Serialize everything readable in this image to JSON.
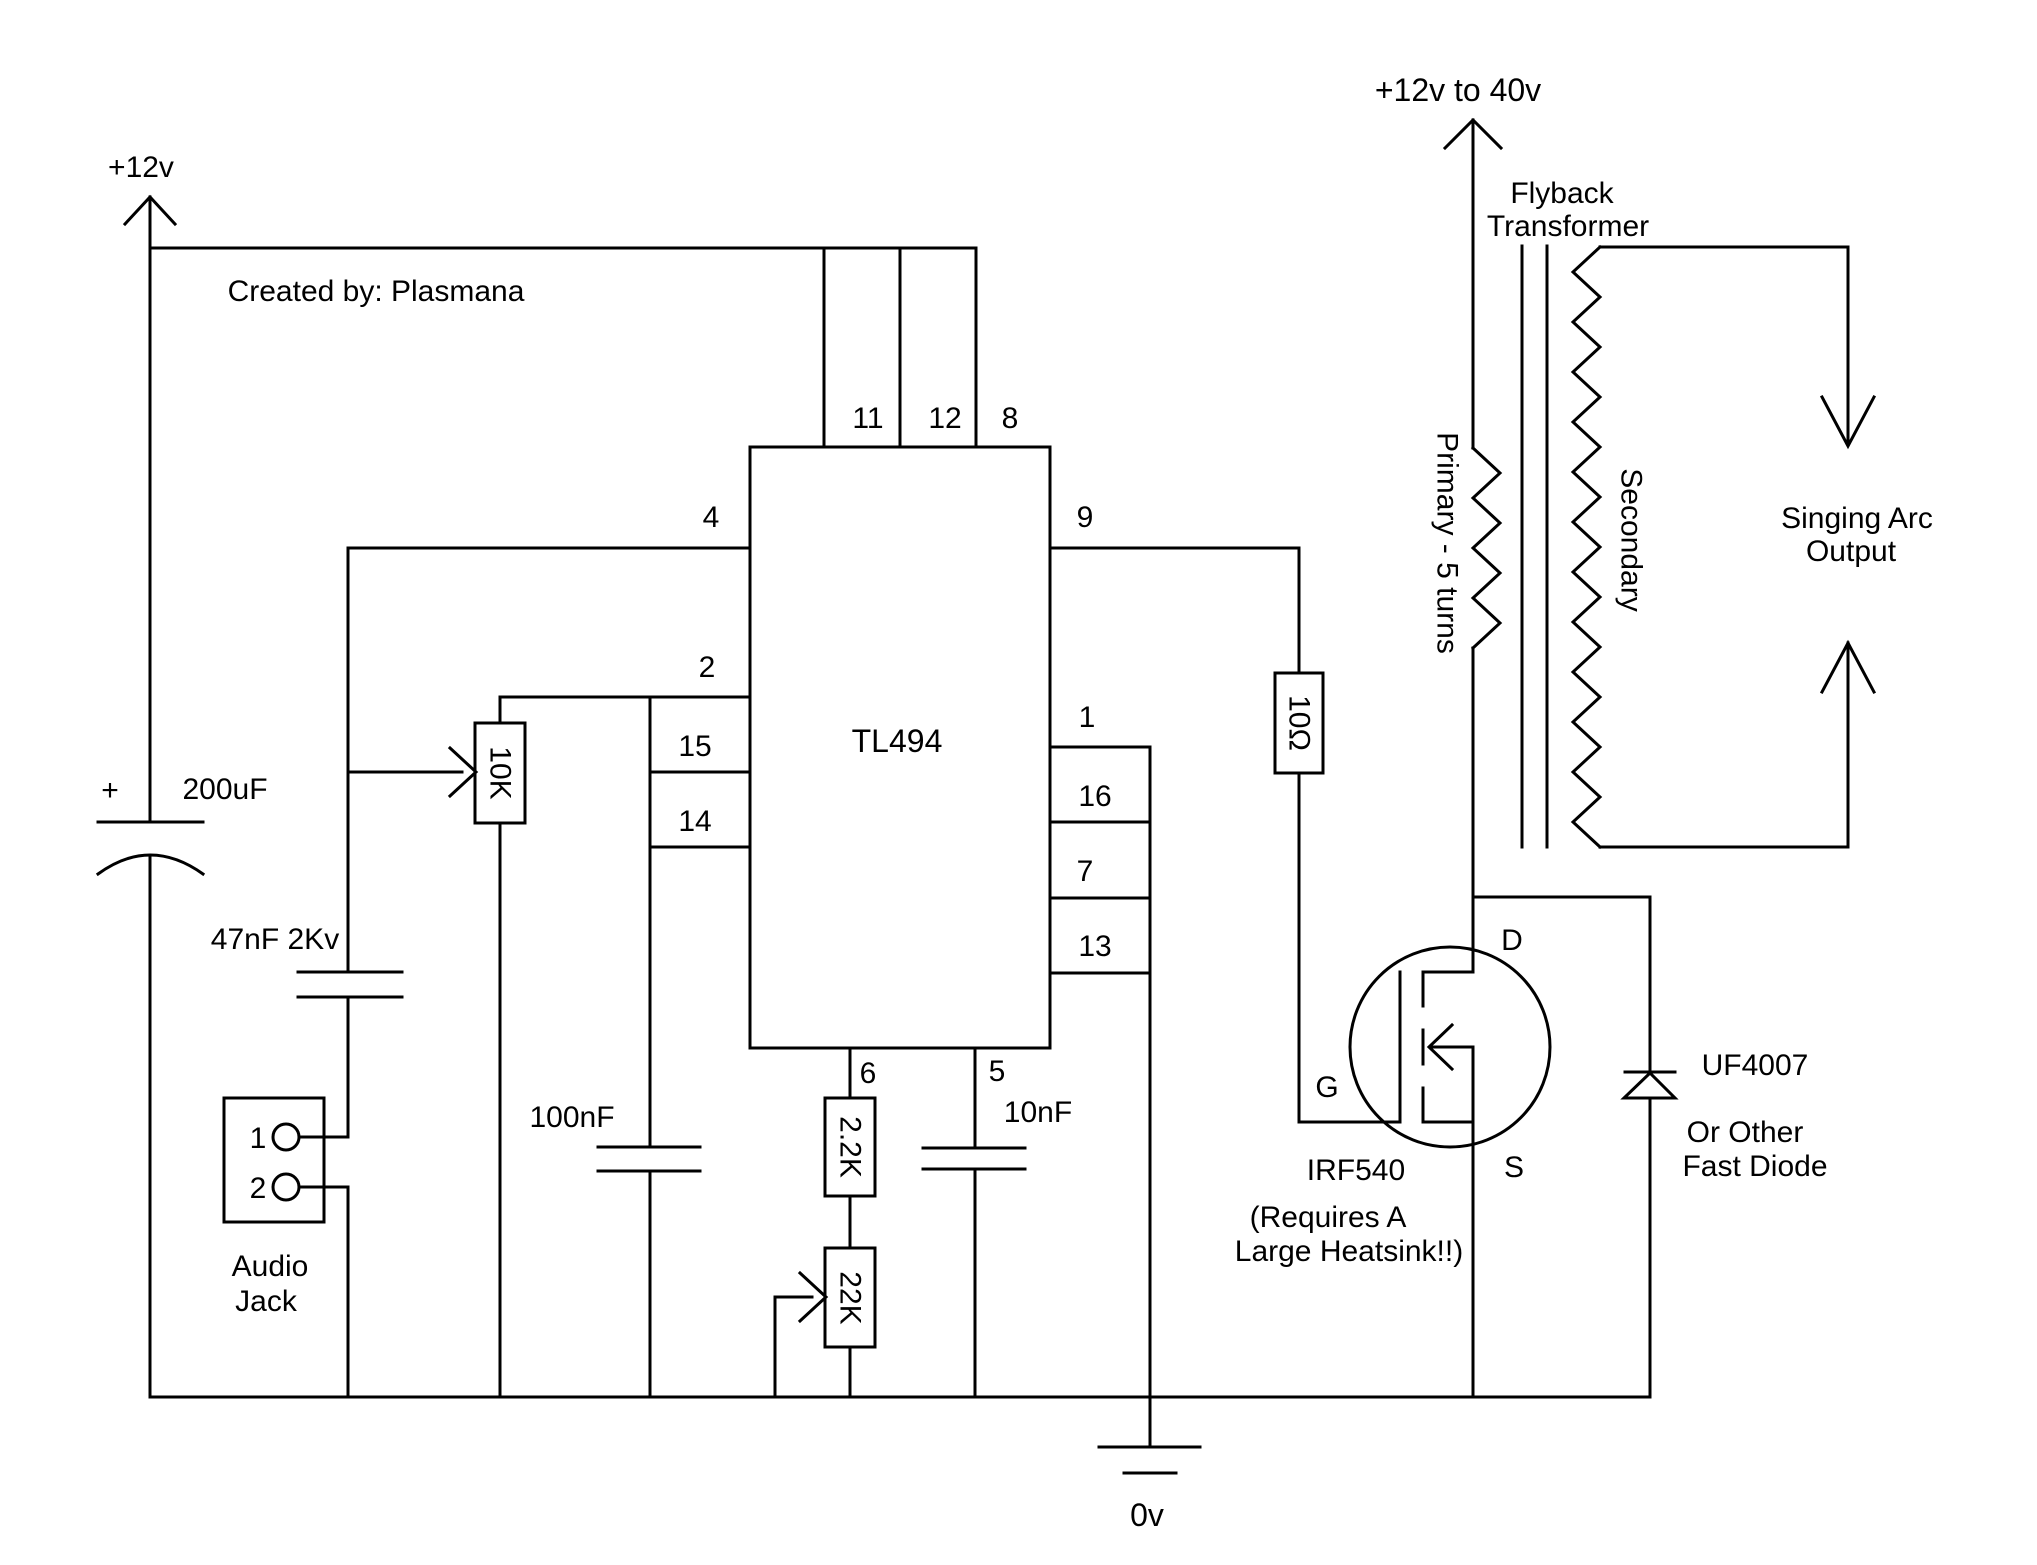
{
  "labels": {
    "supply_left": "+12v",
    "created_by": "Created by: Plasmana",
    "supply_right": "+12v to 40v",
    "flyback_line1": "Flyback",
    "flyback_line2": "Transformer",
    "primary_winding": "Primary - 5 turns",
    "secondary_winding": "Secondary",
    "output_line1": "Singing Arc",
    "output_line2": "Output",
    "ground": "0v"
  },
  "ic": {
    "name": "TL494",
    "pins": {
      "top": [
        "11",
        "12",
        "8"
      ],
      "left": [
        "4",
        "2",
        "15",
        "14"
      ],
      "right": [
        "9",
        "1",
        "16",
        "7",
        "13"
      ],
      "bottom": [
        "6",
        "5"
      ]
    }
  },
  "components": {
    "cap_filter": {
      "value": "200uF",
      "polarity": "+"
    },
    "cap_coupling": {
      "value": "47nF 2Kv"
    },
    "audio_jack": {
      "pin1": "1",
      "pin2": "2",
      "label_line1": "Audio",
      "label_line2": "Jack"
    },
    "pot_audio_level": {
      "value": "10K"
    },
    "cap_100n": {
      "value": "100nF"
    },
    "res_2k2": {
      "value": "2.2K"
    },
    "pot_22k": {
      "value": "22K"
    },
    "cap_10n": {
      "value": "10nF"
    },
    "res_gate": {
      "value": "10Ω"
    },
    "mosfet": {
      "name": "IRF540",
      "gate": "G",
      "drain": "D",
      "source": "S",
      "note_line1": "(Requires A",
      "note_line2": "Large Heatsink!!)"
    },
    "diode": {
      "name": "UF4007",
      "note_line1": "Or Other",
      "note_line2": "Fast Diode"
    }
  },
  "colors": {
    "line": "#000000",
    "background": "#ffffff"
  }
}
